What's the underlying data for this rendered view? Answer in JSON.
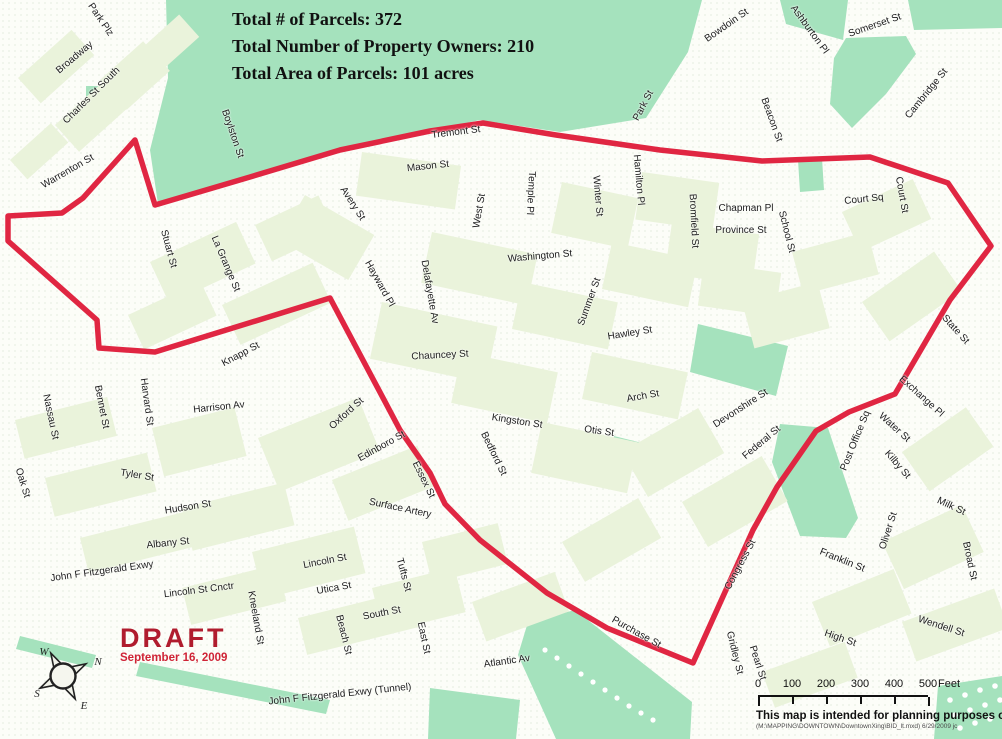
{
  "header": {
    "stats": [
      "Total # of Parcels: 372",
      "Total Number of Property Owners: 210",
      "Total Area of Parcels: 101 acres"
    ]
  },
  "draft": {
    "label": "DRAFT",
    "date": "September 16, 2009"
  },
  "compass": {
    "n": "N",
    "e": "E",
    "s": "S",
    "w": "W"
  },
  "scale_bar": {
    "tick_labels": [
      "0",
      "100",
      "200",
      "300",
      "400",
      "500"
    ],
    "unit": "Feet"
  },
  "footer": {
    "disclaimer": "This map is intended for planning purposes only.",
    "file_note": "(M:\\MAPPING\\DOWNTOWN\\DowntownXing\\BID_lt.mxd) 6/29/2009  jc"
  },
  "colors": {
    "boundary": "#e02642",
    "draft": "#b01c2e",
    "park": "#a5e2bd",
    "block": "#eaf3db"
  },
  "boundary": {
    "name": "Downtown BID boundary (draft)",
    "points": "135,140 155,205 250,177 340,150 430,131 483,123 556,135 660,150 762,161 870,157 948,183 991,246 950,300 895,394 849,412 816,431 777,487 753,530 693,663 607,628 547,593 480,540 445,504 430,473 400,430 330,298 155,352 99,348 97,320 8,241 8,216 62,213 83,198"
  },
  "streets": [
    {
      "n": "Park Plz",
      "x": 100,
      "y": 20,
      "r": 56
    },
    {
      "n": "Broadway",
      "x": 75,
      "y": 58,
      "r": -40
    },
    {
      "n": "Charles St South",
      "x": 92,
      "y": 96,
      "r": -45
    },
    {
      "n": "Warrenton St",
      "x": 68,
      "y": 172,
      "r": -30
    },
    {
      "n": "Boylston St",
      "x": 232,
      "y": 134,
      "r": 71
    },
    {
      "n": "Stuart St",
      "x": 168,
      "y": 249,
      "r": 75
    },
    {
      "n": "La Grange St",
      "x": 225,
      "y": 264,
      "r": 67
    },
    {
      "n": "Tremont St",
      "x": 456,
      "y": 133,
      "r": -7
    },
    {
      "n": "Mason St",
      "x": 428,
      "y": 167,
      "r": -6
    },
    {
      "n": "Avery St",
      "x": 352,
      "y": 204,
      "r": 57
    },
    {
      "n": "Hayward Pl",
      "x": 379,
      "y": 284,
      "r": 61
    },
    {
      "n": "Delafayette Av",
      "x": 429,
      "y": 292,
      "r": 80
    },
    {
      "n": "West St",
      "x": 480,
      "y": 211,
      "r": -80
    },
    {
      "n": "Temple Pl",
      "x": 530,
      "y": 193,
      "r": 93
    },
    {
      "n": "Washington St",
      "x": 540,
      "y": 257,
      "r": -5
    },
    {
      "n": "Winter St",
      "x": 597,
      "y": 196,
      "r": 85
    },
    {
      "n": "Summer St",
      "x": 590,
      "y": 302,
      "r": -70
    },
    {
      "n": "Park St",
      "x": 644,
      "y": 106,
      "r": -62
    },
    {
      "n": "Hamilton Pl",
      "x": 638,
      "y": 180,
      "r": 85
    },
    {
      "n": "Bromfield St",
      "x": 693,
      "y": 221,
      "r": 87
    },
    {
      "n": "Chapman Pl",
      "x": 746,
      "y": 209,
      "r": 0
    },
    {
      "n": "Province St",
      "x": 741,
      "y": 231,
      "r": 0
    },
    {
      "n": "School St",
      "x": 786,
      "y": 232,
      "r": 76
    },
    {
      "n": "Beacon St",
      "x": 771,
      "y": 120,
      "r": 70
    },
    {
      "n": "Bowdoin St",
      "x": 727,
      "y": 26,
      "r": -35
    },
    {
      "n": "Ashburton Pl",
      "x": 809,
      "y": 30,
      "r": 54
    },
    {
      "n": "Somerset St",
      "x": 875,
      "y": 26,
      "r": -19
    },
    {
      "n": "Cambridge St",
      "x": 927,
      "y": 94,
      "r": -51
    },
    {
      "n": "Court Sq",
      "x": 864,
      "y": 200,
      "r": -6
    },
    {
      "n": "Court St",
      "x": 901,
      "y": 195,
      "r": 80
    },
    {
      "n": "State St",
      "x": 955,
      "y": 330,
      "r": 48
    },
    {
      "n": "Exchange Pl",
      "x": 921,
      "y": 397,
      "r": 42
    },
    {
      "n": "Water St",
      "x": 894,
      "y": 428,
      "r": 42
    },
    {
      "n": "Kilby St",
      "x": 897,
      "y": 465,
      "r": 49
    },
    {
      "n": "Post Office Sq",
      "x": 856,
      "y": 441,
      "r": -68
    },
    {
      "n": "Milk St",
      "x": 951,
      "y": 507,
      "r": 25
    },
    {
      "n": "Oliver St",
      "x": 889,
      "y": 531,
      "r": -72
    },
    {
      "n": "Franklin St",
      "x": 842,
      "y": 561,
      "r": 22
    },
    {
      "n": "Broad St",
      "x": 969,
      "y": 561,
      "r": 78
    },
    {
      "n": "Wendell St",
      "x": 941,
      "y": 627,
      "r": 18
    },
    {
      "n": "High St",
      "x": 840,
      "y": 639,
      "r": 19
    },
    {
      "n": "Congress St",
      "x": 741,
      "y": 565,
      "r": -62
    },
    {
      "n": "Gridley St",
      "x": 734,
      "y": 653,
      "r": 76
    },
    {
      "n": "Pearl St",
      "x": 757,
      "y": 663,
      "r": 72
    },
    {
      "n": "Purchase St",
      "x": 636,
      "y": 633,
      "r": 29
    },
    {
      "n": "Devonshire St",
      "x": 741,
      "y": 409,
      "r": -33
    },
    {
      "n": "Federal St",
      "x": 762,
      "y": 443,
      "r": -40
    },
    {
      "n": "Chauncey St",
      "x": 440,
      "y": 356,
      "r": -3
    },
    {
      "n": "Hawley St",
      "x": 630,
      "y": 334,
      "r": -9
    },
    {
      "n": "Arch St",
      "x": 643,
      "y": 397,
      "r": -10
    },
    {
      "n": "Kingston St",
      "x": 517,
      "y": 422,
      "r": 9
    },
    {
      "n": "Otis St",
      "x": 599,
      "y": 432,
      "r": 8
    },
    {
      "n": "Bedford St",
      "x": 493,
      "y": 454,
      "r": 64
    },
    {
      "n": "Essex St",
      "x": 423,
      "y": 480,
      "r": 64
    },
    {
      "n": "Edinboro St",
      "x": 382,
      "y": 447,
      "r": -29
    },
    {
      "n": "Oxford St",
      "x": 347,
      "y": 414,
      "r": -42
    },
    {
      "n": "Surface Artery",
      "x": 400,
      "y": 509,
      "r": 12
    },
    {
      "n": "Knapp St",
      "x": 241,
      "y": 355,
      "r": -28
    },
    {
      "n": "Harrison Av",
      "x": 219,
      "y": 408,
      "r": -6
    },
    {
      "n": "Oak St",
      "x": 22,
      "y": 483,
      "r": 73
    },
    {
      "n": "Nassau St",
      "x": 50,
      "y": 417,
      "r": 78
    },
    {
      "n": "Bennet St",
      "x": 101,
      "y": 407,
      "r": 79
    },
    {
      "n": "Harvard St",
      "x": 146,
      "y": 402,
      "r": 82
    },
    {
      "n": "Tyler St",
      "x": 137,
      "y": 476,
      "r": 9
    },
    {
      "n": "Hudson St",
      "x": 188,
      "y": 508,
      "r": -9
    },
    {
      "n": "Albany St",
      "x": 168,
      "y": 544,
      "r": -6
    },
    {
      "n": "John F Fitzgerald Exwy",
      "x": 102,
      "y": 572,
      "r": -8
    },
    {
      "n": "Lincoln St Cnctr",
      "x": 199,
      "y": 591,
      "r": -7
    },
    {
      "n": "Kneeland St",
      "x": 255,
      "y": 618,
      "r": 80
    },
    {
      "n": "Lincoln St",
      "x": 325,
      "y": 562,
      "r": -11
    },
    {
      "n": "Utica St",
      "x": 334,
      "y": 589,
      "r": -10
    },
    {
      "n": "Tufts St",
      "x": 403,
      "y": 575,
      "r": 75
    },
    {
      "n": "Beach St",
      "x": 343,
      "y": 635,
      "r": 76
    },
    {
      "n": "South St",
      "x": 382,
      "y": 614,
      "r": -11
    },
    {
      "n": "East St",
      "x": 423,
      "y": 638,
      "r": 78
    },
    {
      "n": "Atlantic Av",
      "x": 507,
      "y": 662,
      "r": -8
    },
    {
      "n": "John F Fitzgerald Exwy (Tunnel)",
      "x": 340,
      "y": 695,
      "r": -6
    }
  ]
}
